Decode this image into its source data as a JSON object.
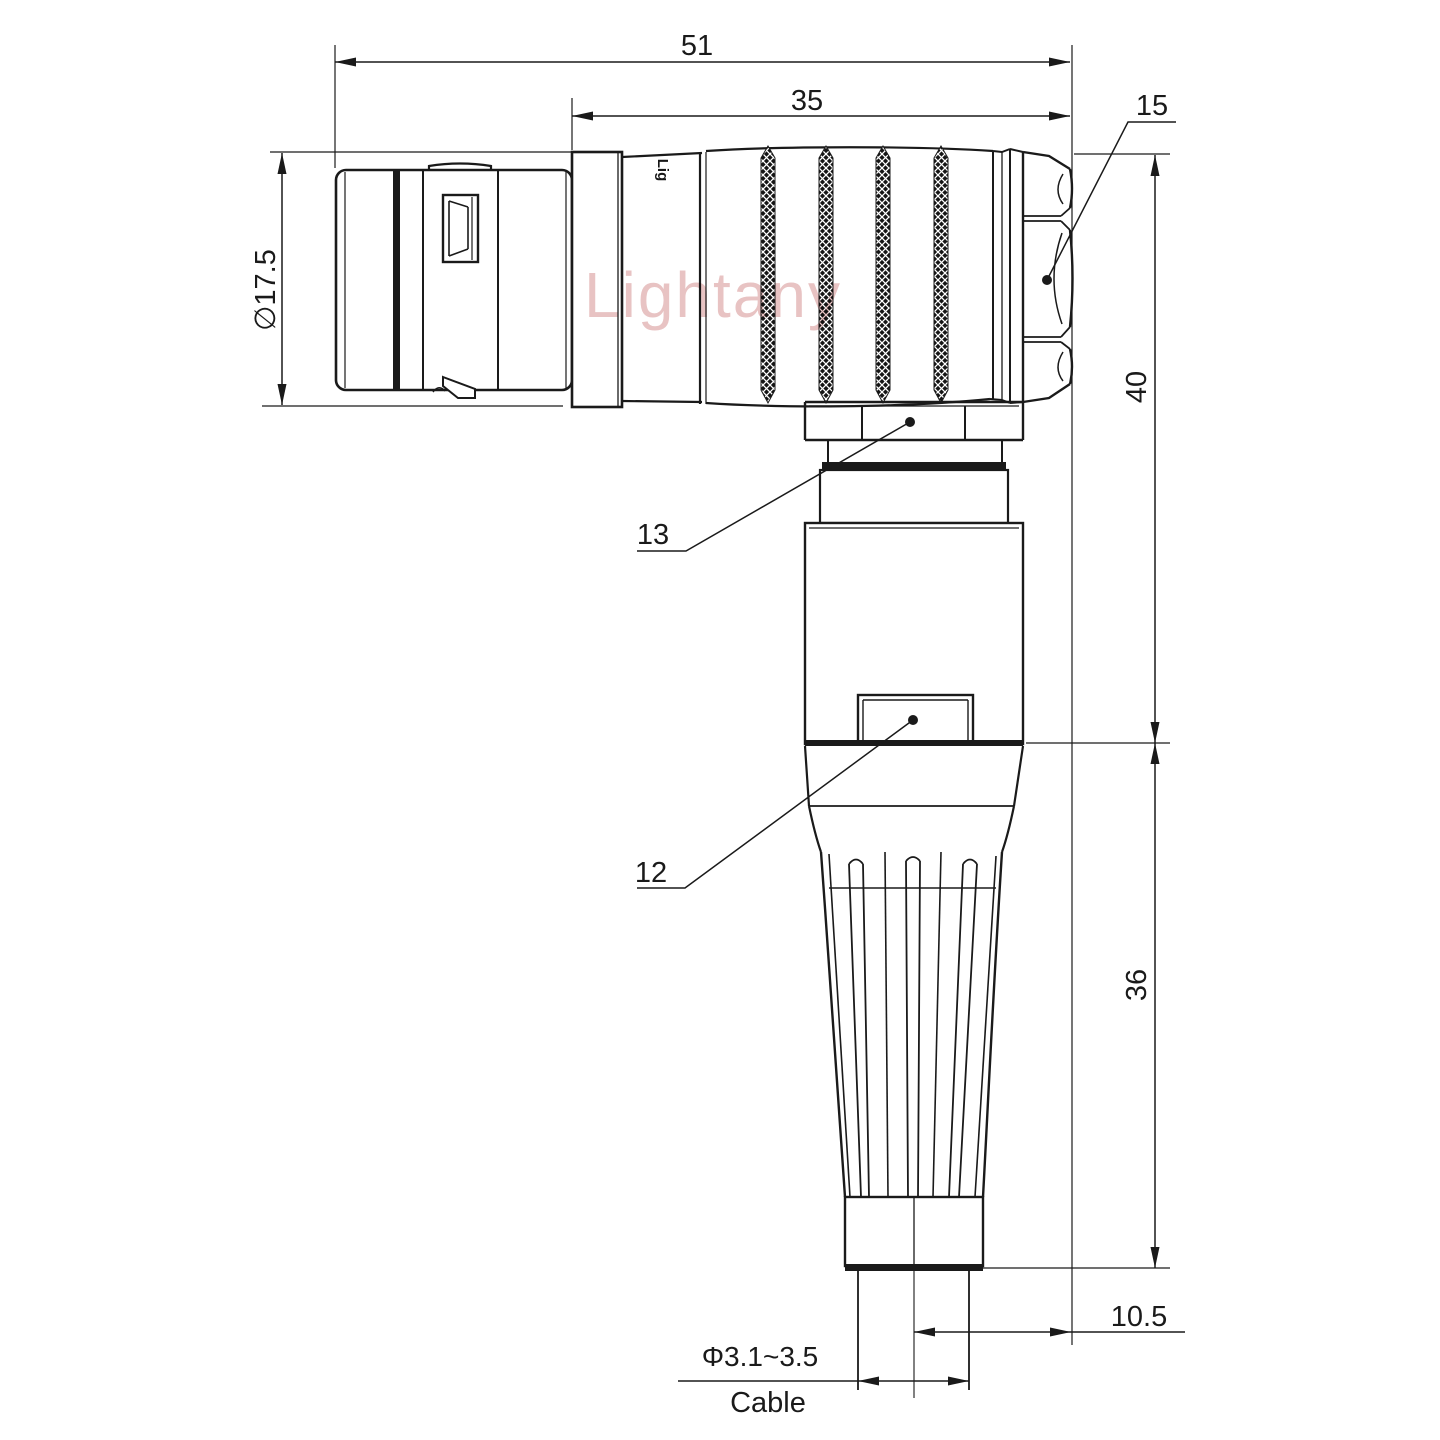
{
  "watermark_text": "Lightany",
  "body_logo_text": "Lig",
  "dimensions": {
    "overall_length": "51",
    "rear_length": "35",
    "nut_callout": "15",
    "front_diameter": "∅17.5",
    "upper_height": "40",
    "lower_height": "36",
    "side_offset": "10.5",
    "cable_diameter": "Φ3.1~3.5",
    "cable_caption": "Cable"
  },
  "part_callouts": {
    "collar_nut": "13",
    "housing": "12"
  },
  "colors": {
    "line": "#1a1a1a",
    "watermark_pink": "#cc7a7a",
    "background": "#ffffff"
  }
}
